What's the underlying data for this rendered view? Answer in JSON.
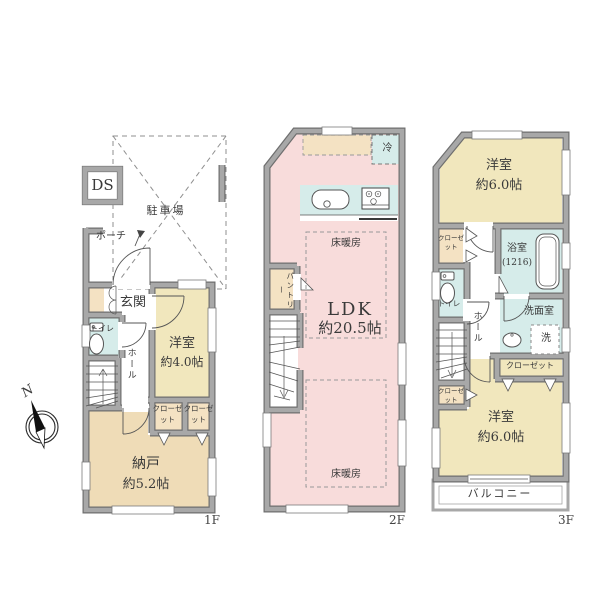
{
  "colors": {
    "wall_gray": "#a8a8a8",
    "ldk_pink": "#f8dcdb",
    "bedroom_yellow": "#f1e7bd",
    "storage_tan": "#efdcb7",
    "closet_beige": "#f4e2c3",
    "wet_area_teal": "#d6ecea"
  },
  "compass": {
    "north": "N"
  },
  "floor1": {
    "label": "1F",
    "ds": "DS",
    "parking": "駐車場",
    "porch": "ポーチ",
    "entrance": "玄関",
    "toilet": "トイレ",
    "hall": "ホール",
    "bedroom": {
      "name": "洋室",
      "size": "約4.0帖"
    },
    "closet_a": "クローゼット",
    "closet_b": "クローゼット",
    "storage": {
      "name": "納戸",
      "size": "約5.2帖"
    }
  },
  "floor2": {
    "label": "2F",
    "fridge": "冷",
    "pantry": "パントリー",
    "floor_heating_upper": "床暖房",
    "floor_heating_lower": "床暖房",
    "ldk": {
      "name": "LDK",
      "size": "約20.5帖"
    }
  },
  "floor3": {
    "label": "3F",
    "bedroom_upper": {
      "name": "洋室",
      "size": "約6.0帖"
    },
    "closet_upper": "クローゼット",
    "bath": {
      "name": "浴室",
      "size": "(1216)"
    },
    "toilet": "トイレ",
    "hall": "ホール",
    "washroom": "洗面室",
    "washer": "洗",
    "closet_middle": "クローゼット",
    "closet_lower": "クローゼット",
    "bedroom_lower": {
      "name": "洋室",
      "size": "約6.0帖"
    },
    "balcony": "バルコニー"
  }
}
